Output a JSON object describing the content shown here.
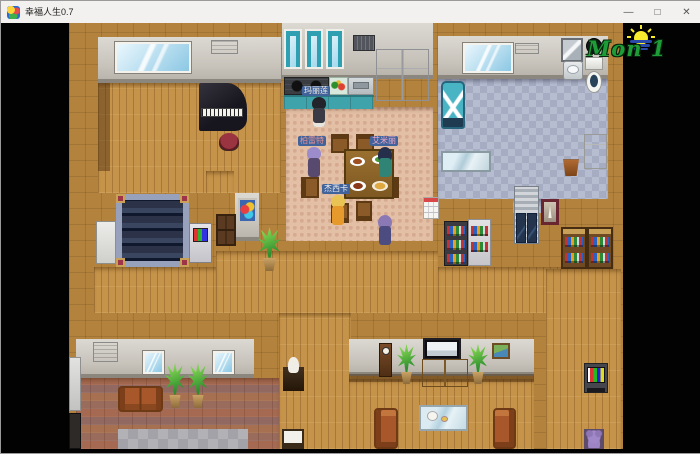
{
  "window": {
    "title": "幸福人生0.7",
    "minimize": "—",
    "maximize": "□",
    "close": "✕"
  },
  "hud": {
    "day": "Mon 1",
    "day_color": "#1d9c38"
  },
  "characters": {
    "cook": {
      "name": "玛丽莲",
      "label_bg": "#41639b",
      "label_color": "#f0ece4"
    },
    "diner_left": {
      "name": "柏雷特",
      "label_bg": "#41639b",
      "label_color": "#e89090"
    },
    "diner_right": {
      "name": "艾米丽",
      "label_bg": "#41639b",
      "label_color": "#f0a8c8"
    },
    "diner_bottom": {
      "name": "杰西卡",
      "label_bg": "#41639b",
      "label_color": "#f2f2f2"
    }
  }
}
